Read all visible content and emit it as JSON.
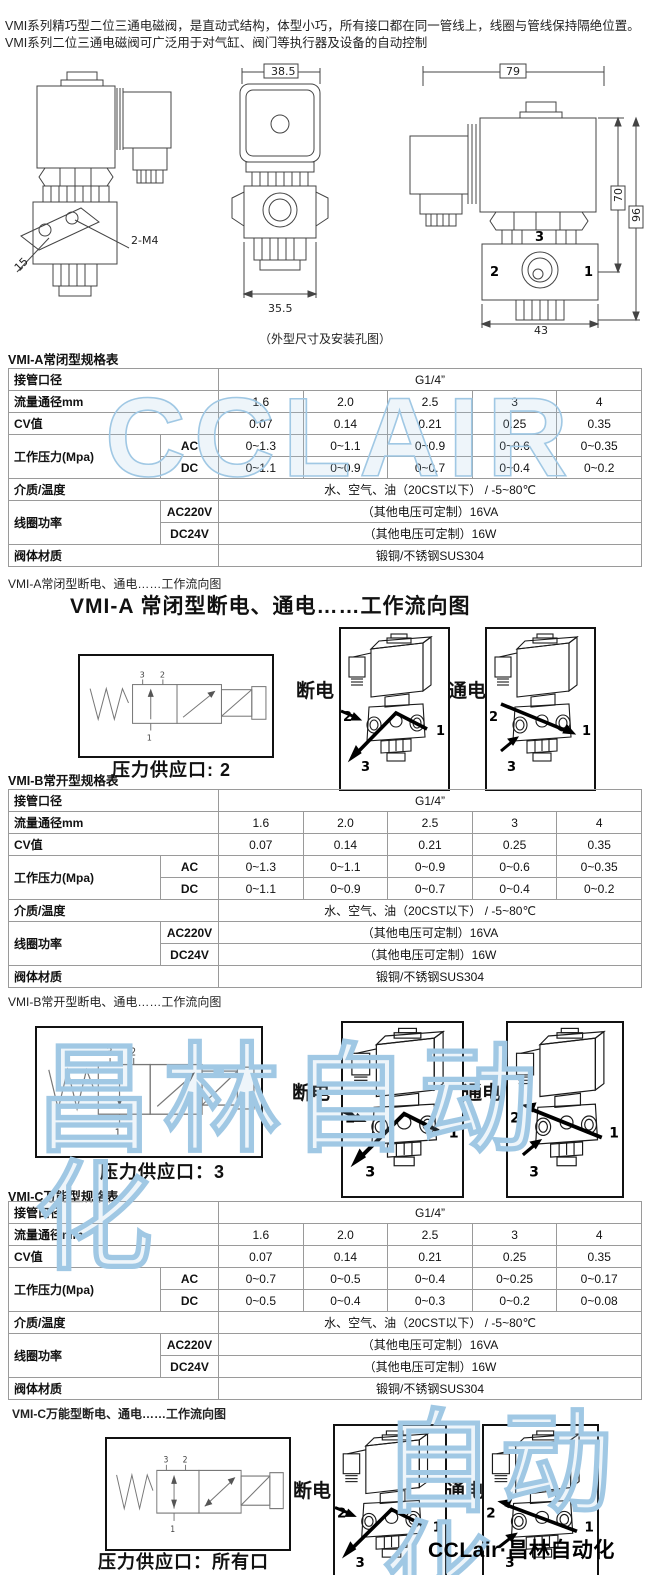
{
  "intro": "VMI系列精巧型二位三通电磁阀，是直动式结构，体型小巧，所有接口都在同一管线上，线圈与管线保持隔绝位置。VMI系列二位三通电磁阀可广泛用于对气缸、阀门等执行器及设备的自动控制",
  "drawings": {
    "caption": "（外型尺寸及安装孔图）",
    "dims": {
      "holes": "2-M4",
      "plate": "15",
      "coil_width": "38.5",
      "body_front_width": "35.5",
      "total_width": "79",
      "body_height": "70",
      "total_height": "96",
      "body_side_width": "43"
    }
  },
  "ports": {
    "p1": "1",
    "p2": "2",
    "p3": "3"
  },
  "states": {
    "off": "断电",
    "on": "通电"
  },
  "vmi_a": {
    "title": "VMI-A常闭型规格表",
    "table": {
      "port_label": "接管口径",
      "port_value": "G1/4”",
      "flow_label": "流量通径mm",
      "flow_values": [
        "1.6",
        "2.0",
        "2.5",
        "3",
        "4"
      ],
      "cv_label": "CV值",
      "cv_values": [
        "0.07",
        "0.14",
        "0.21",
        "0.25",
        "0.35"
      ],
      "pressure_label": "工作压力(Mpa)",
      "ac_label": "AC",
      "ac_values": [
        "0~1.3",
        "0~1.1",
        "0~0.9",
        "0~0.6",
        "0~0.35"
      ],
      "dc_label": "DC",
      "dc_values": [
        "0~1.1",
        "0~0.9",
        "0~0.7",
        "0~0.4",
        "0~0.2"
      ],
      "media_label": "介质/温度",
      "media_value": "水、空气、油（20CST以下） / -5~80℃",
      "coil_label": "线圈功率",
      "ac220_label": "AC220V",
      "ac220_value": "（其他电压可定制）16VA",
      "dc24_label": "DC24V",
      "dc24_value": "（其他电压可定制）16W",
      "body_label": "阀体材质",
      "body_value": "锻铜/不锈钢SUS304"
    },
    "flow_note": "VMI-A常闭型断电、通电……工作流向图",
    "flow_heading": "VMI-A 常闭型断电、通电……工作流向图",
    "supply": "压力供应口: 2"
  },
  "vmi_b": {
    "title": "VMI-B常开型规格表",
    "table": {
      "port_label": "接管口径",
      "port_value": "G1/4”",
      "flow_label": "流量通径mm",
      "flow_values": [
        "1.6",
        "2.0",
        "2.5",
        "3",
        "4"
      ],
      "cv_label": "CV值",
      "cv_values": [
        "0.07",
        "0.14",
        "0.21",
        "0.25",
        "0.35"
      ],
      "pressure_label": "工作压力(Mpa)",
      "ac_label": "AC",
      "ac_values": [
        "0~1.3",
        "0~1.1",
        "0~0.9",
        "0~0.6",
        "0~0.35"
      ],
      "dc_label": "DC",
      "dc_values": [
        "0~1.1",
        "0~0.9",
        "0~0.7",
        "0~0.4",
        "0~0.2"
      ],
      "media_label": "介质/温度",
      "media_value": "水、空气、油（20CST以下） / -5~80℃",
      "coil_label": "线圈功率",
      "ac220_label": "AC220V",
      "ac220_value": "（其他电压可定制）16VA",
      "dc24_label": "DC24V",
      "dc24_value": "（其他电压可定制）16W",
      "body_label": "阀体材质",
      "body_value": "锻铜/不锈钢SUS304"
    },
    "flow_note": "VMI-B常开型断电、通电……工作流向图",
    "supply": "压力供应口：3"
  },
  "vmi_c": {
    "title": "VMI-C万能型规格表",
    "table": {
      "port_label": "接管口径",
      "port_value": "G1/4”",
      "flow_label": "流量通径mm",
      "flow_values": [
        "1.6",
        "2.0",
        "2.5",
        "3",
        "4"
      ],
      "cv_label": "CV值",
      "cv_values": [
        "0.07",
        "0.14",
        "0.21",
        "0.25",
        "0.35"
      ],
      "pressure_label": "工作压力(Mpa)",
      "ac_label": "AC",
      "ac_values": [
        "0~0.7",
        "0~0.5",
        "0~0.4",
        "0~0.25",
        "0~0.17"
      ],
      "dc_label": "DC",
      "dc_values": [
        "0~0.5",
        "0~0.4",
        "0~0.3",
        "0~0.2",
        "0~0.08"
      ],
      "media_label": "介质/温度",
      "media_value": "水、空气、油（20CST以下） / -5~80℃",
      "coil_label": "线圈功率",
      "ac220_label": "AC220V",
      "ac220_value": "（其他电压可定制）16VA",
      "dc24_label": "DC24V",
      "dc24_value": "（其他电压可定制）16W",
      "body_label": "阀体材质",
      "body_value": "锻铜/不锈钢SUS304"
    },
    "flow_note": "VMI-C万能型断电、通电……工作流向图",
    "supply": "压力供应口：所有口"
  },
  "watermarks": {
    "wm1": "CCLAIR",
    "wm2": "昌林自动化",
    "wm3": "自动化"
  },
  "footer": "CCLair·昌林自动化"
}
